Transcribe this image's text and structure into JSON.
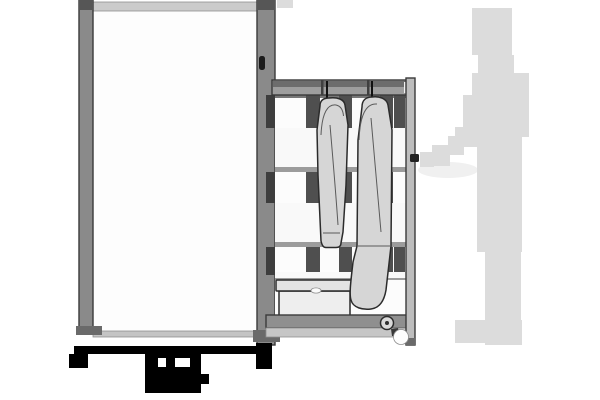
{
  "colors": {
    "background": "#ffffff",
    "frame_gray": "#8a8a8a",
    "cap_dark": "#565656",
    "foot_dark": "#6a6a6a",
    "top_rail_light": "#cbcbcb",
    "rail_extension_light": "#dcdcdc",
    "interior_white": "#fdfdfd",
    "sill_gray": "#c4c4c4",
    "latch_dark": "#1b1b1b",
    "rail_gray": "#9e9e9e",
    "rail_dark_strip": "#6d6d6d",
    "rail_divider_dark": "#3f3f3f",
    "rail_slot_white": "#f2f2f2",
    "gap_white": "#fcfcfc",
    "gap_shadow": "#777777",
    "post_dark": "#4f4f4f",
    "post_darker": "#3d3d3d",
    "slat_white": "#f9f9f9",
    "slat_edge_gray": "#9c9c9c",
    "right_post_gray": "#bdbdbd",
    "handle_dark": "#222222",
    "bottom_rail_gray": "#8f8f8f",
    "bottom_band_gray": "#c6c6c6",
    "pulley_gray": "#d9d9d9",
    "pulley_center_dark": "#2e2e2e",
    "wheel_white": "#fdfdfd",
    "wheel_bracket_dark": "#383838",
    "garment_gray": "#d6d6d6",
    "box_lid_gray": "#e3e3e3",
    "box_body_gray": "#eeeeee",
    "box_hole_white": "#fbfbfb",
    "person_gray": "#dcdcdc",
    "hand_shadow_light": "#f0f0f0",
    "base_black": "#000000",
    "notch_white": "#ffffff"
  }
}
